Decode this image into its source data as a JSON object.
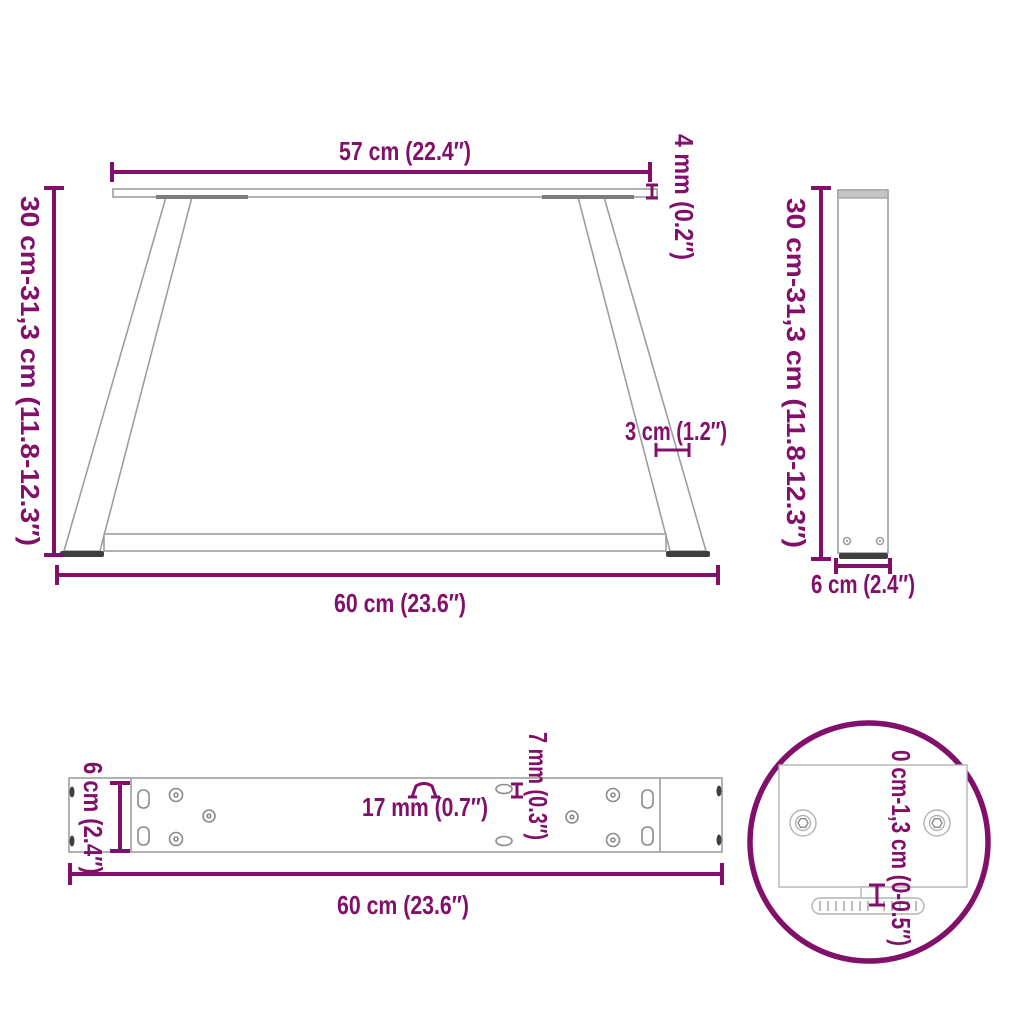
{
  "colors": {
    "accent": "#82106B",
    "structure_outline": "#9e9e9e",
    "dark_parts": "#3f3f3f",
    "background": "#ffffff"
  },
  "diagram": {
    "subject": "table-leg-dimension-diagram",
    "views": {
      "front": {
        "top_width_label": "57 cm (22.4″)",
        "top_thickness_label": "4 mm (0.2″)",
        "height_label": "30 cm-31,3 cm (11.8-12.3″)",
        "leg_width_label": "3 cm (1.2″)",
        "bottom_width_label": "60 cm (23.6″)"
      },
      "side": {
        "height_label": "30 cm-31,3 cm (11.8-12.3″)",
        "depth_label": "6 cm (2.4″)"
      },
      "plate_top": {
        "depth_label": "6 cm (2.4″)",
        "slot_width_label": "17 mm (0.7″)",
        "hole_width_label": "7 mm (0.3″)",
        "width_label": "60 cm (23.6″)"
      },
      "detail": {
        "adjust_range_label": "0 cm-1,3 cm (0-0.5″)"
      }
    }
  }
}
